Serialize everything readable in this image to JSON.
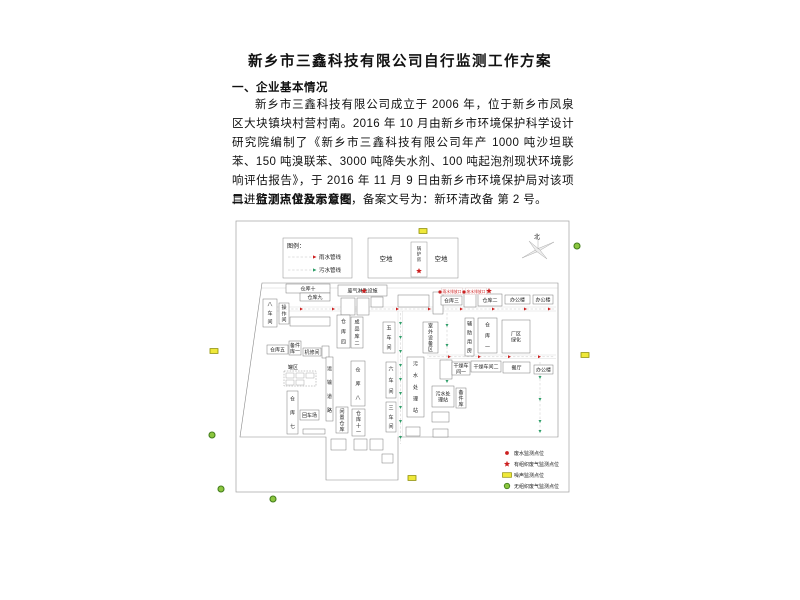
{
  "document": {
    "title": "新乡市三鑫科技有限公司自行监测工作方案",
    "section1_heading": "一、企业基本情况",
    "paragraph": "新乡市三鑫科技有限公司成立于 2006 年，位于新乡市凤泉区大块镇块村营村南。2016 年 10 月由新乡市环境保护科学设计研究院编制了《新乡市三鑫科技有限公司年产 1000 吨沙坦联苯、150 吨溴联苯、3000 吨降失水剂、100 吨起泡剂现状环境影响评估报告》，于 2016 年 11 月 9 日由新乡市环境保护局对该项目进行了环保备案公告，备案文号为：新环清改备 第 2 号。",
    "section2_heading": "二、监测点位及示意图"
  },
  "map": {
    "colors": {
      "rain": "#cc1f1f",
      "sewage": "#2f9e68",
      "noise": "#efe83a",
      "noise_border": "#8f8f00",
      "fugitive": "#8cc63f",
      "fugitive_border": "#447f1d"
    },
    "boundary": [
      [
        262,
        283
      ],
      [
        558,
        283
      ],
      [
        558,
        437
      ],
      [
        398,
        437
      ],
      [
        398,
        480
      ],
      [
        326,
        480
      ],
      [
        326,
        437
      ],
      [
        240,
        437
      ]
    ],
    "roads": [
      [
        264,
        307,
        556,
        307
      ],
      [
        264,
        311,
        556,
        311
      ],
      [
        398,
        311,
        398,
        437
      ],
      [
        402.5,
        311,
        402.5,
        437
      ],
      [
        427,
        355,
        556,
        355
      ],
      [
        427,
        358.5,
        556,
        358.5
      ]
    ],
    "rain_lines": [
      [
        266,
        309,
        554,
        309
      ],
      [
        429,
        356.8,
        554,
        356.8
      ]
    ],
    "rain_arrows": [
      [
        300,
        309
      ],
      [
        332,
        309
      ],
      [
        364,
        309
      ],
      [
        396,
        309
      ],
      [
        428,
        309
      ],
      [
        460,
        309
      ],
      [
        492,
        309
      ],
      [
        524,
        309
      ],
      [
        548,
        309
      ],
      [
        448,
        356.8
      ],
      [
        478,
        356.8
      ],
      [
        508,
        356.8
      ],
      [
        538,
        356.8
      ]
    ],
    "sewage_lines": [
      [
        400.5,
        313,
        400.5,
        444
      ],
      [
        447,
        313,
        447,
        383
      ],
      [
        540,
        362,
        540,
        432
      ]
    ],
    "sewage_arrows": [
      [
        400.5,
        322
      ],
      [
        400.5,
        336
      ],
      [
        400.5,
        350
      ],
      [
        400.5,
        364
      ],
      [
        400.5,
        378
      ],
      [
        400.5,
        392
      ],
      [
        400.5,
        406
      ],
      [
        400.5,
        420
      ],
      [
        400.5,
        436
      ],
      [
        447,
        324
      ],
      [
        447,
        344
      ],
      [
        447,
        364
      ],
      [
        447,
        380
      ],
      [
        540,
        376
      ],
      [
        540,
        398
      ],
      [
        540,
        420
      ],
      [
        540,
        430
      ]
    ],
    "pipe_legend": {
      "x": 283,
      "y": 238,
      "w": 69,
      "h": 40,
      "title": "图例：",
      "items": [
        {
          "label": "雨水管线",
          "color": "#cc1f1f"
        },
        {
          "label": "污水管线",
          "color": "#2f9e68"
        }
      ]
    },
    "open_area": {
      "x": 368,
      "y": 238,
      "w": 90,
      "h": 40,
      "labels": [
        "空地",
        "空地"
      ],
      "boiler": "锅炉房"
    },
    "compass": {
      "label": "北",
      "cx": 538,
      "cy": 250
    },
    "tank": {
      "label": "罐区",
      "x": 284,
      "y": 371,
      "w": 32,
      "h": 15,
      "cells": [
        [
          286,
          373
        ],
        [
          296,
          373
        ],
        [
          306,
          373
        ],
        [
          286,
          380
        ],
        [
          296,
          380
        ]
      ]
    },
    "buildings": [
      [
        "仓库十",
        286,
        284,
        44,
        9,
        "h"
      ],
      [
        "仓库九",
        300,
        293,
        30,
        8,
        "h"
      ],
      [
        "八车间",
        263,
        299,
        14,
        28,
        "v"
      ],
      [
        "操作间",
        279,
        303,
        10,
        21,
        "v"
      ],
      [
        "",
        290,
        317,
        40,
        9,
        "h"
      ],
      [
        "废气淋洗设施",
        338,
        285,
        49,
        11,
        "h"
      ],
      [
        "",
        341,
        298,
        14,
        17,
        "h"
      ],
      [
        "",
        357,
        298,
        12,
        17,
        "h"
      ],
      [
        "",
        371,
        297,
        12,
        10,
        "h"
      ],
      [
        "",
        398,
        295,
        31,
        12,
        "h"
      ],
      [
        "",
        433,
        292,
        10,
        22,
        "v"
      ],
      [
        "仓库三",
        441,
        296,
        21,
        9,
        "h"
      ],
      [
        "",
        464,
        292,
        12,
        15,
        "h"
      ],
      [
        "仓库二",
        478,
        294,
        24,
        12,
        "h"
      ],
      [
        "办公楼",
        505,
        295,
        25,
        9,
        "h"
      ],
      [
        "办公楼",
        533,
        295,
        20,
        9,
        "h"
      ],
      [
        "仓库四",
        337,
        315,
        13,
        33,
        "v"
      ],
      [
        "成品库二",
        351,
        317,
        12,
        31,
        "v"
      ],
      [
        "五车间",
        383,
        322,
        12,
        31,
        "v"
      ],
      [
        "室外设备区",
        423,
        322,
        15,
        31,
        "v"
      ],
      [
        "辅助用房",
        465,
        318,
        9,
        38,
        "v"
      ],
      [
        "仓库一",
        478,
        318,
        19,
        35,
        "v"
      ],
      [
        "厂区\n绿化",
        502,
        320,
        28,
        33,
        "h"
      ],
      [
        "仓库五",
        267,
        345,
        21,
        9,
        "h"
      ],
      [
        "备件\n库一",
        289,
        341,
        12,
        14,
        "h"
      ],
      [
        "机修间",
        303,
        348,
        18,
        8,
        "h"
      ],
      [
        "",
        322,
        346,
        7,
        12,
        "h"
      ],
      [
        "运输道路",
        326,
        357,
        7,
        64,
        "v"
      ],
      [
        "仓库八",
        351,
        361,
        14,
        45,
        "v"
      ],
      [
        "六车间",
        386,
        362,
        10,
        36,
        "v"
      ],
      [
        "三车间",
        386,
        402,
        10,
        30,
        "v"
      ],
      [
        "污水处理站",
        407,
        357,
        17,
        60,
        "v"
      ],
      [
        "仓库七",
        287,
        391,
        11,
        43,
        "v"
      ],
      [
        "回车场",
        300,
        410,
        19,
        10,
        "h"
      ],
      [
        "闲置仓库",
        336,
        407,
        12,
        26,
        "v"
      ],
      [
        "仓库十一",
        352,
        409,
        13,
        27,
        "v"
      ],
      [
        "",
        440,
        360,
        12,
        19,
        "h"
      ],
      [
        "干燥车\n间一",
        452,
        362,
        18,
        13,
        "h"
      ],
      [
        "干燥车间二",
        471,
        361,
        30,
        11,
        "h"
      ],
      [
        "餐厅",
        503,
        362,
        27,
        11,
        "h"
      ],
      [
        "办公楼",
        534,
        365,
        19,
        9,
        "h"
      ],
      [
        "污水处\n理站",
        432,
        386,
        22,
        21,
        "h"
      ],
      [
        "备件库",
        456,
        388,
        10,
        20,
        "v"
      ],
      [
        "",
        432,
        412,
        17,
        10,
        "h"
      ],
      [
        "",
        406,
        427,
        14,
        9,
        "h"
      ],
      [
        "",
        433,
        429,
        15,
        8,
        "h"
      ],
      [
        "",
        331,
        439,
        15,
        11,
        "h"
      ],
      [
        "",
        354,
        439,
        13,
        11,
        "h"
      ],
      [
        "",
        370,
        439,
        13,
        11,
        "h"
      ],
      [
        "",
        382,
        454,
        11,
        9,
        "h"
      ],
      [
        "",
        303,
        429,
        22,
        5,
        "h"
      ]
    ],
    "outfalls": [
      {
        "label": "雨水排放口",
        "x": 443,
        "y": 288
      },
      {
        "label": "废水排放口",
        "x": 467,
        "y": 288
      }
    ],
    "point_legend": {
      "y": 453,
      "items": [
        {
          "symbol": "red-dot",
          "label": "废水监测点位"
        },
        {
          "symbol": "red-star",
          "label": "有组织废气监测点位"
        },
        {
          "symbol": "yellow-rect",
          "label": "噪声监测点位"
        },
        {
          "symbol": "green-circle",
          "label": "无组织废气监测点位"
        }
      ]
    },
    "markers": {
      "noise": [
        [
          423,
          231
        ],
        [
          214,
          351
        ],
        [
          585,
          355
        ],
        [
          412,
          478
        ]
      ],
      "fugitive_gas": [
        [
          577,
          246
        ],
        [
          212,
          435
        ],
        [
          221,
          489
        ],
        [
          273,
          499
        ]
      ],
      "stack_gas": [
        [
          419,
          271
        ],
        [
          364,
          291
        ],
        [
          489,
          291
        ]
      ],
      "wastewater": [
        [
          440,
          292
        ],
        [
          464,
          292
        ]
      ]
    }
  }
}
